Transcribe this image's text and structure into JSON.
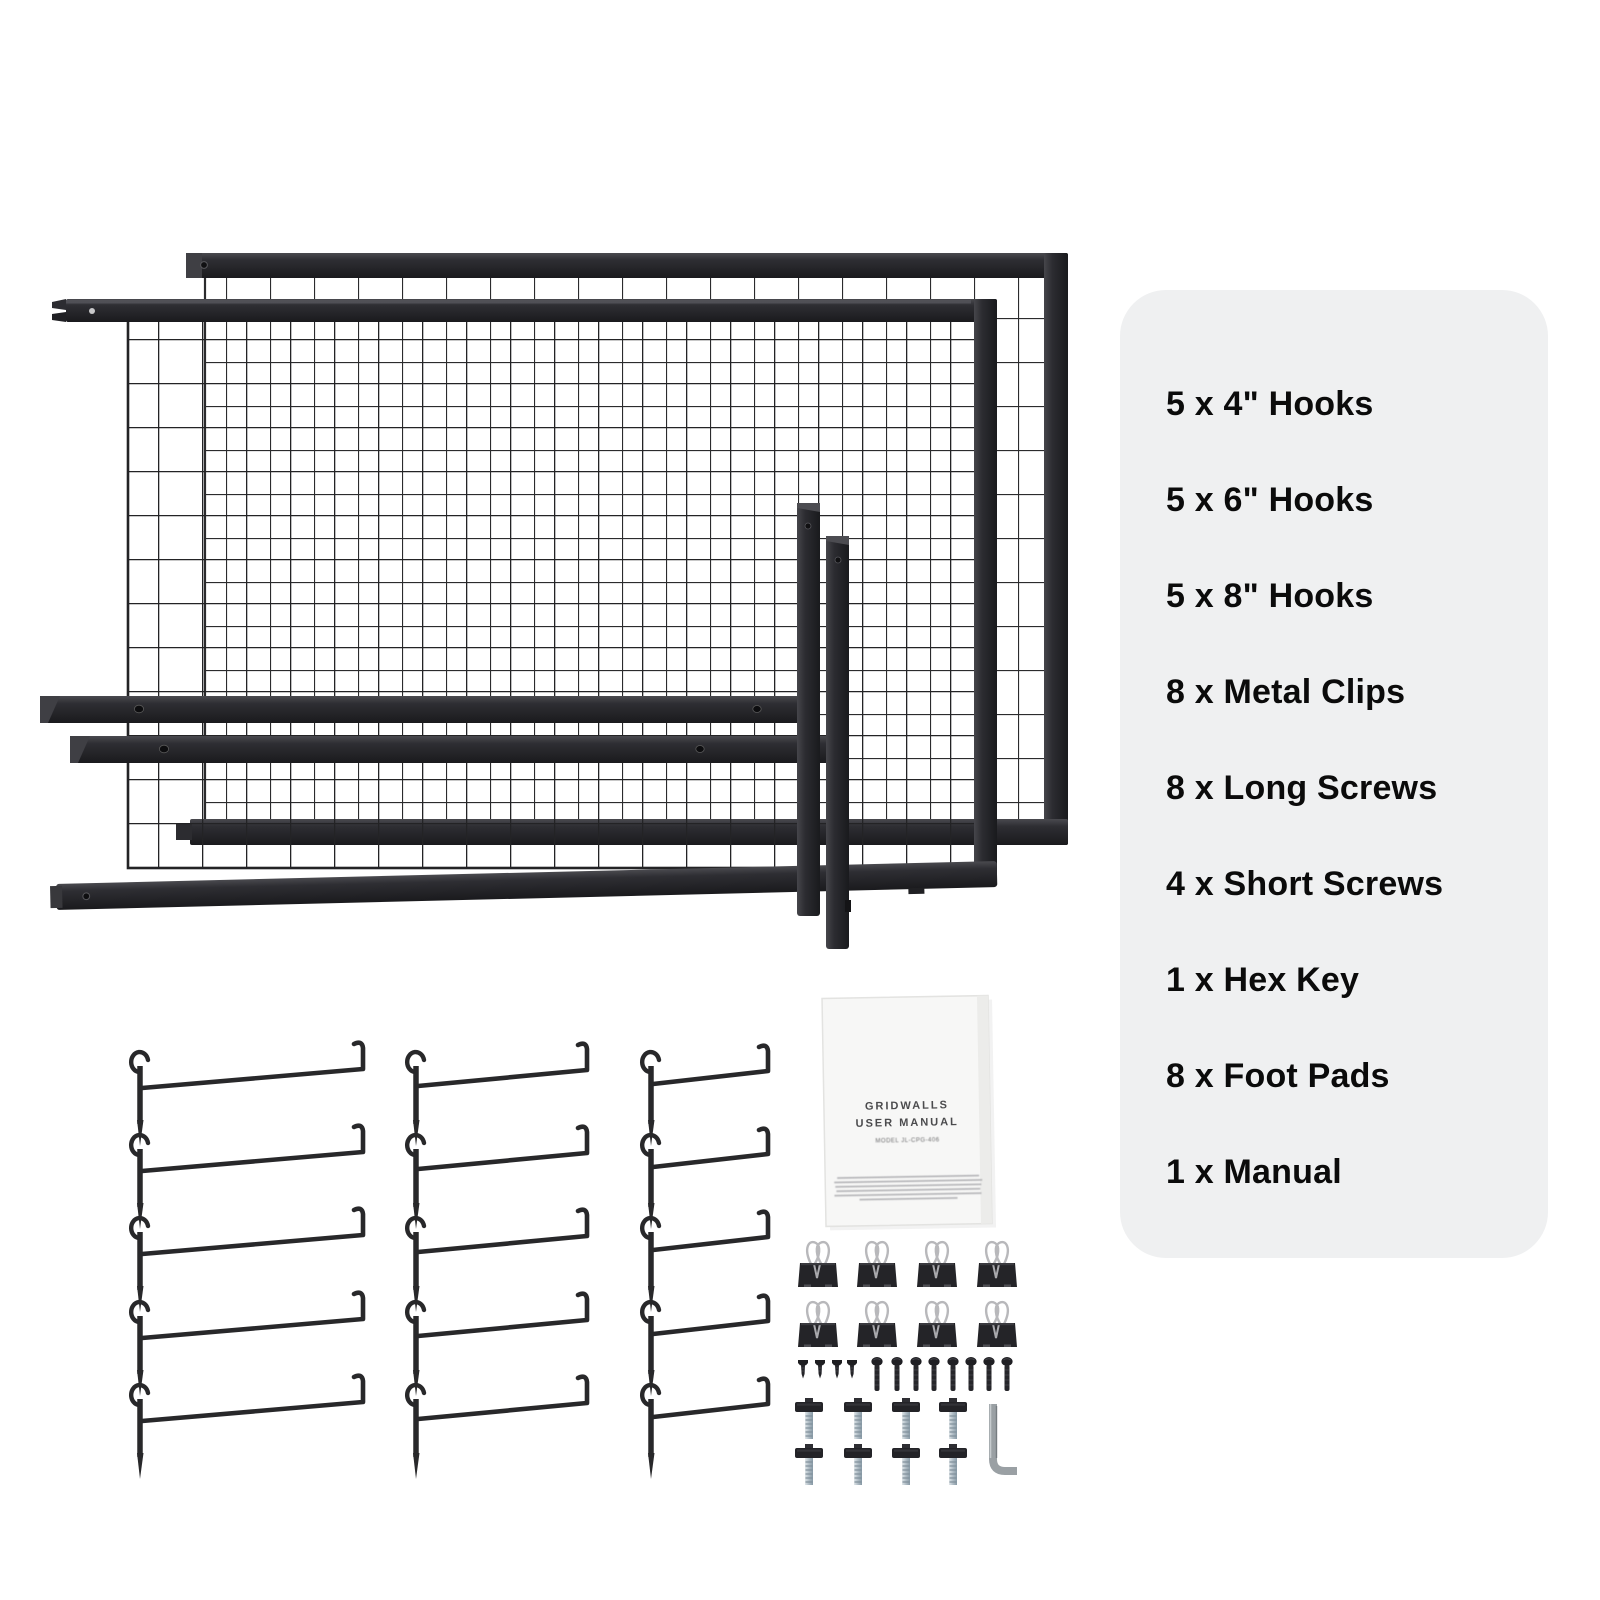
{
  "page": {
    "background": "#ffffff"
  },
  "parts_panel": {
    "background": "#eff0f1",
    "text_color": "#0b0b0b",
    "items": [
      "5 x 4\" Hooks",
      "5 x 6\" Hooks",
      "5 x 8\" Hooks",
      "8 x Metal Clips",
      "8 x Long Screws",
      "4 x Short Screws",
      "1 x Hex Key",
      "8 x Foot Pads",
      "1 x Manual"
    ]
  },
  "manual": {
    "line1": "GRIDWALLS",
    "line2": "USER MANUAL",
    "model_line": "MODEL JL-CPG-406"
  },
  "figure_counts": {
    "grid_panels": 2,
    "leg_bars": 4,
    "hooks_4in": 5,
    "hooks_6in": 5,
    "hooks_8in": 5,
    "metal_clips": 8,
    "long_screws": 8,
    "short_screws": 4,
    "foot_pads": 8,
    "hex_keys": 1,
    "manuals": 1
  },
  "colors": {
    "frame_metal": "#26262a",
    "mesh_wire": "#232325",
    "zinc": "#aebbc4",
    "silver_wire": "#b8b8bb",
    "hex_key_silver": "#9aa0a4",
    "manual_paper": "#f7f7f6",
    "manual_text": "#4b4b4d"
  }
}
